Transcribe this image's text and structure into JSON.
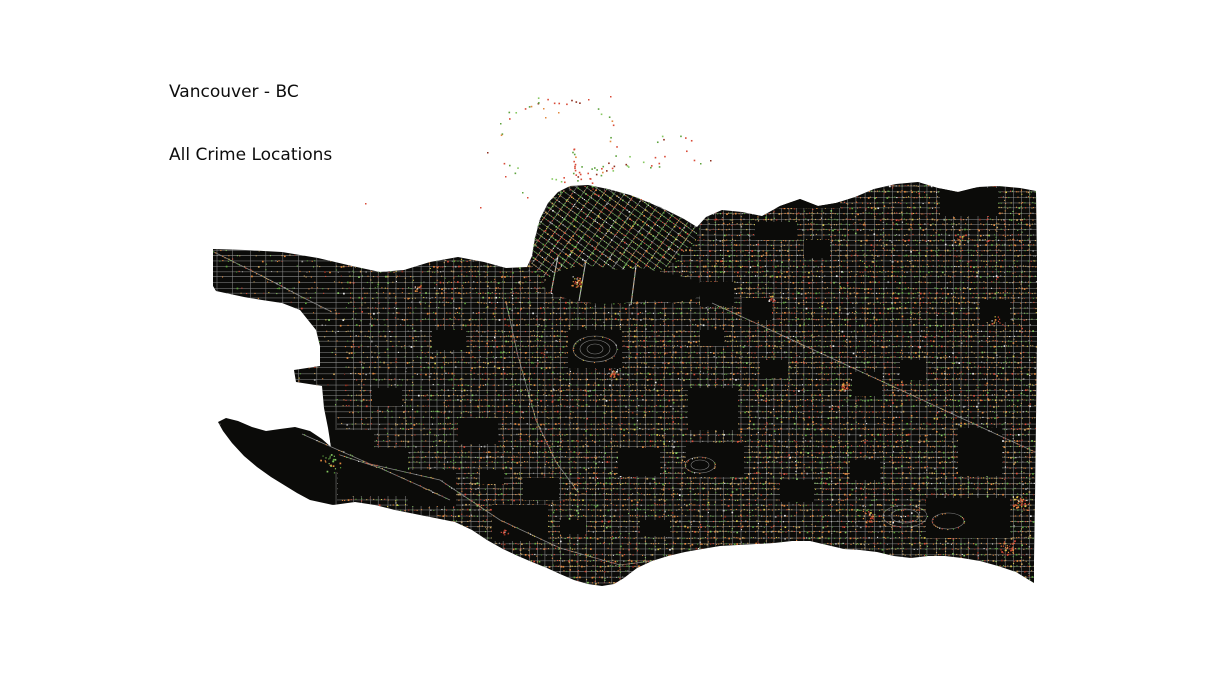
{
  "title": {
    "line1": "Vancouver - BC",
    "line2": "All Crime Locations"
  },
  "map": {
    "background": "#ffffff",
    "land_color": "#0b0b09",
    "street_color": "#8f8f8f",
    "bridge_color": "#b2b2b2",
    "seed": 1337,
    "dot_palettes": {
      "main": [
        [
          "#e2883f",
          0.24
        ],
        [
          "#c9a25e",
          0.2
        ],
        [
          "#5da23d",
          0.15
        ],
        [
          "#86c860",
          0.08
        ],
        [
          "#d94b38",
          0.1
        ],
        [
          "#8e2f1f",
          0.07
        ],
        [
          "#9c9c9c",
          0.08
        ],
        [
          "#ececec",
          0.04
        ],
        [
          "#d8c84a",
          0.04
        ]
      ],
      "downtown": [
        [
          "#5da23d",
          0.26
        ],
        [
          "#86c860",
          0.22
        ],
        [
          "#e2883f",
          0.14
        ],
        [
          "#c9a25e",
          0.08
        ],
        [
          "#d94b38",
          0.12
        ],
        [
          "#ececec",
          0.08
        ],
        [
          "#9c9c9c",
          0.06
        ],
        [
          "#d8c84a",
          0.04
        ]
      ],
      "park": [
        [
          "#d94b38",
          0.42
        ],
        [
          "#8e2f1f",
          0.12
        ],
        [
          "#5da23d",
          0.28
        ],
        [
          "#86c860",
          0.08
        ],
        [
          "#e2883f",
          0.1
        ]
      ],
      "hot": [
        [
          "#e2883f",
          0.35
        ],
        [
          "#d94b38",
          0.3
        ],
        [
          "#d8c84a",
          0.15
        ],
        [
          "#8e2f1f",
          0.1
        ],
        [
          "#ececec",
          0.1
        ]
      ],
      "greens": [
        [
          "#5da23d",
          0.5
        ],
        [
          "#86c860",
          0.3
        ],
        [
          "#e2883f",
          0.2
        ]
      ]
    },
    "landmass": [
      [
        213,
        249
      ],
      [
        245,
        250
      ],
      [
        282,
        252
      ],
      [
        318,
        258
      ],
      [
        352,
        266
      ],
      [
        380,
        272
      ],
      [
        404,
        270
      ],
      [
        430,
        262
      ],
      [
        458,
        257
      ],
      [
        484,
        262
      ],
      [
        506,
        268
      ],
      [
        527,
        267
      ],
      [
        532,
        256
      ],
      [
        535,
        238
      ],
      [
        540,
        219
      ],
      [
        548,
        203
      ],
      [
        558,
        192
      ],
      [
        570,
        186
      ],
      [
        588,
        185
      ],
      [
        608,
        189
      ],
      [
        630,
        195
      ],
      [
        650,
        203
      ],
      [
        668,
        211
      ],
      [
        684,
        219
      ],
      [
        697,
        227
      ],
      [
        706,
        217
      ],
      [
        722,
        210
      ],
      [
        742,
        212
      ],
      [
        762,
        216
      ],
      [
        780,
        206
      ],
      [
        800,
        199
      ],
      [
        818,
        206
      ],
      [
        836,
        203
      ],
      [
        855,
        197
      ],
      [
        874,
        189
      ],
      [
        896,
        184
      ],
      [
        918,
        182
      ],
      [
        938,
        188
      ],
      [
        958,
        192
      ],
      [
        978,
        187
      ],
      [
        998,
        186
      ],
      [
        1020,
        188
      ],
      [
        1036,
        191
      ],
      [
        1037,
        260
      ],
      [
        1037,
        340
      ],
      [
        1036,
        420
      ],
      [
        1035,
        500
      ],
      [
        1034,
        560
      ],
      [
        1034,
        583
      ],
      [
        1016,
        572
      ],
      [
        998,
        566
      ],
      [
        980,
        561
      ],
      [
        962,
        558
      ],
      [
        945,
        556
      ],
      [
        928,
        556
      ],
      [
        911,
        558
      ],
      [
        894,
        556
      ],
      [
        877,
        552
      ],
      [
        860,
        550
      ],
      [
        844,
        549
      ],
      [
        827,
        545
      ],
      [
        810,
        541
      ],
      [
        792,
        541
      ],
      [
        774,
        543
      ],
      [
        756,
        544
      ],
      [
        738,
        545
      ],
      [
        720,
        546
      ],
      [
        702,
        549
      ],
      [
        685,
        552
      ],
      [
        668,
        556
      ],
      [
        652,
        561
      ],
      [
        637,
        568
      ],
      [
        624,
        578
      ],
      [
        614,
        584
      ],
      [
        602,
        586
      ],
      [
        588,
        584
      ],
      [
        574,
        580
      ],
      [
        560,
        574
      ],
      [
        547,
        568
      ],
      [
        532,
        562
      ],
      [
        518,
        556
      ],
      [
        503,
        549
      ],
      [
        487,
        540
      ],
      [
        472,
        530
      ],
      [
        455,
        522
      ],
      [
        435,
        518
      ],
      [
        415,
        514
      ],
      [
        395,
        510
      ],
      [
        375,
        505
      ],
      [
        355,
        502
      ],
      [
        333,
        505
      ],
      [
        310,
        500
      ],
      [
        297,
        493
      ],
      [
        284,
        485
      ],
      [
        271,
        477
      ],
      [
        257,
        467
      ],
      [
        244,
        456
      ],
      [
        232,
        443
      ],
      [
        223,
        431
      ],
      [
        218,
        422
      ],
      [
        226,
        418
      ],
      [
        238,
        421
      ],
      [
        252,
        427
      ],
      [
        266,
        431
      ],
      [
        280,
        429
      ],
      [
        295,
        427
      ],
      [
        310,
        431
      ],
      [
        322,
        439
      ],
      [
        331,
        447
      ],
      [
        328,
        428
      ],
      [
        324,
        408
      ],
      [
        322,
        386
      ],
      [
        296,
        382
      ],
      [
        294,
        370
      ],
      [
        320,
        366
      ],
      [
        320,
        346
      ],
      [
        316,
        330
      ],
      [
        300,
        310
      ],
      [
        282,
        303
      ],
      [
        262,
        300
      ],
      [
        244,
        297
      ],
      [
        230,
        294
      ],
      [
        216,
        291
      ],
      [
        213,
        286
      ]
    ],
    "downtown": [
      [
        531,
        262
      ],
      [
        534,
        240
      ],
      [
        539,
        220
      ],
      [
        548,
        203
      ],
      [
        560,
        192
      ],
      [
        574,
        186
      ],
      [
        592,
        186
      ],
      [
        612,
        190
      ],
      [
        634,
        196
      ],
      [
        654,
        204
      ],
      [
        672,
        212
      ],
      [
        688,
        221
      ],
      [
        699,
        229
      ],
      [
        693,
        243
      ],
      [
        680,
        256
      ],
      [
        664,
        268
      ],
      [
        646,
        279
      ],
      [
        628,
        288
      ],
      [
        610,
        294
      ],
      [
        592,
        297
      ],
      [
        574,
        294
      ],
      [
        557,
        287
      ],
      [
        543,
        277
      ],
      [
        534,
        269
      ]
    ],
    "false_creek": [
      [
        543,
        283
      ],
      [
        556,
        272
      ],
      [
        574,
        267
      ],
      [
        596,
        266
      ],
      [
        618,
        270
      ],
      [
        640,
        268
      ],
      [
        662,
        272
      ],
      [
        684,
        277
      ],
      [
        702,
        283
      ],
      [
        708,
        291
      ],
      [
        694,
        299
      ],
      [
        672,
        303
      ],
      [
        648,
        300
      ],
      [
        624,
        303
      ],
      [
        600,
        304
      ],
      [
        576,
        301
      ],
      [
        558,
        296
      ],
      [
        546,
        290
      ]
    ],
    "quiet_zones": [
      [
        218,
        416,
        118,
        86
      ]
    ],
    "patches": [
      [
        940,
        188,
        58,
        28
      ],
      [
        755,
        222,
        42,
        18
      ],
      [
        695,
        196,
        145,
        12
      ],
      [
        688,
        388,
        50,
        42
      ],
      [
        686,
        443,
        58,
        34
      ],
      [
        618,
        448,
        42,
        28
      ],
      [
        742,
        298,
        30,
        22
      ],
      [
        700,
        282,
        34,
        24
      ],
      [
        852,
        372,
        30,
        24
      ],
      [
        926,
        498,
        84,
        40
      ],
      [
        958,
        428,
        44,
        48
      ],
      [
        432,
        330,
        34,
        20
      ],
      [
        458,
        418,
        40,
        26
      ],
      [
        523,
        478,
        36,
        22
      ],
      [
        372,
        388,
        30,
        18
      ],
      [
        804,
        240,
        26,
        18
      ],
      [
        700,
        330,
        24,
        16
      ],
      [
        760,
        360,
        28,
        18
      ],
      [
        900,
        360,
        26,
        20
      ],
      [
        980,
        300,
        30,
        22
      ],
      [
        850,
        460,
        30,
        20
      ],
      [
        780,
        480,
        34,
        22
      ],
      [
        640,
        520,
        30,
        16
      ],
      [
        560,
        520,
        26,
        14
      ],
      [
        480,
        470,
        24,
        14
      ],
      [
        330,
        430,
        44,
        42
      ],
      [
        568,
        330,
        54,
        38
      ],
      [
        338,
        448,
        70,
        48
      ],
      [
        408,
        470,
        48,
        36
      ],
      [
        492,
        505,
        56,
        36
      ]
    ],
    "curvy_areas": [
      {
        "cx": 595,
        "cy": 349,
        "rings": [
          [
            22,
            13
          ],
          [
            15,
            9
          ],
          [
            8,
            5
          ]
        ]
      },
      {
        "cx": 905,
        "cy": 516,
        "rings": [
          [
            22,
            11
          ],
          [
            14,
            7
          ]
        ]
      },
      {
        "cx": 948,
        "cy": 521,
        "rings": [
          [
            16,
            8
          ]
        ]
      },
      {
        "cx": 700,
        "cy": 465,
        "rings": [
          [
            15,
            8
          ],
          [
            9,
            5
          ]
        ]
      }
    ],
    "arterials": [
      {
        "name": "kingsway",
        "pts": [
          [
            712,
            303
          ],
          [
            1035,
            452
          ]
        ]
      },
      {
        "name": "marine-drive",
        "pts": [
          [
            302,
            434
          ],
          [
            370,
            464
          ],
          [
            440,
            480
          ],
          [
            500,
            520
          ],
          [
            560,
            548
          ],
          [
            620,
            565
          ],
          [
            660,
            560
          ],
          [
            720,
            548
          ]
        ]
      },
      {
        "name": "nw-marine-drive",
        "pts": [
          [
            214,
            252
          ],
          [
            262,
            276
          ],
          [
            300,
            296
          ],
          [
            332,
            312
          ]
        ]
      },
      {
        "name": "arbutus-corridor",
        "pts": [
          [
            506,
            302
          ],
          [
            518,
            356
          ],
          [
            536,
            420
          ],
          [
            556,
            462
          ],
          [
            578,
            492
          ]
        ]
      },
      {
        "name": "southlands-street",
        "pts": [
          [
            340,
            455
          ],
          [
            380,
            468
          ],
          [
            420,
            486
          ],
          [
            450,
            500
          ]
        ]
      }
    ],
    "bridges": [
      [
        [
          558,
          256
        ],
        [
          551,
          293
        ]
      ],
      [
        [
          586,
          260
        ],
        [
          579,
          301
        ]
      ],
      [
        [
          636,
          266
        ],
        [
          631,
          305
        ]
      ]
    ],
    "hotspots": [
      {
        "x": 577,
        "y": 281,
        "r": 7,
        "count": 30,
        "palette": "hot"
      },
      {
        "x": 845,
        "y": 388,
        "r": 7,
        "count": 26,
        "palette": "hot"
      },
      {
        "x": 613,
        "y": 372,
        "r": 6,
        "count": 18,
        "palette": "hot"
      },
      {
        "x": 869,
        "y": 517,
        "r": 8,
        "count": 22,
        "palette": "hot"
      },
      {
        "x": 1020,
        "y": 500,
        "r": 10,
        "count": 40,
        "palette": "hot"
      },
      {
        "x": 1008,
        "y": 548,
        "r": 9,
        "count": 30,
        "palette": "hot"
      },
      {
        "x": 770,
        "y": 300,
        "r": 6,
        "count": 14,
        "palette": "hot"
      },
      {
        "x": 505,
        "y": 530,
        "r": 5,
        "count": 10,
        "palette": "hot"
      },
      {
        "x": 418,
        "y": 288,
        "r": 5,
        "count": 12,
        "palette": "hot"
      },
      {
        "x": 958,
        "y": 238,
        "r": 6,
        "count": 12,
        "palette": "hot"
      },
      {
        "x": 996,
        "y": 320,
        "r": 6,
        "count": 10,
        "palette": "hot"
      },
      {
        "x": 330,
        "y": 463,
        "r": 12,
        "count": 24,
        "palette": "greens"
      }
    ],
    "park_scatter": {
      "ring": {
        "cx": 557,
        "cy": 140,
        "rx": 57,
        "ry": 41,
        "count": 46
      },
      "chains": [
        {
          "from": [
            573,
            147
          ],
          "to": [
            576,
            176
          ],
          "count": 12
        },
        {
          "from": [
            589,
            179
          ],
          "to": [
            597,
            195
          ],
          "count": 7
        }
      ],
      "clusters": [
        {
          "rect": [
            566,
            165,
            50,
            10
          ],
          "count": 14
        },
        {
          "rect": [
            618,
            155,
            42,
            12
          ],
          "count": 10
        },
        {
          "rect": [
            652,
            126,
            52,
            40
          ],
          "count": 9
        }
      ],
      "outliers": [
        [
          487,
          152
        ],
        [
          505,
          176
        ],
        [
          522,
          192
        ],
        [
          500,
          123
        ],
        [
          527,
          197
        ],
        [
          543,
          108
        ],
        [
          558,
          112
        ],
        [
          365,
          203
        ],
        [
          480,
          207
        ],
        [
          610,
          96
        ],
        [
          588,
          99
        ],
        [
          545,
          117
        ],
        [
          700,
          163
        ],
        [
          710,
          160
        ]
      ]
    }
  }
}
